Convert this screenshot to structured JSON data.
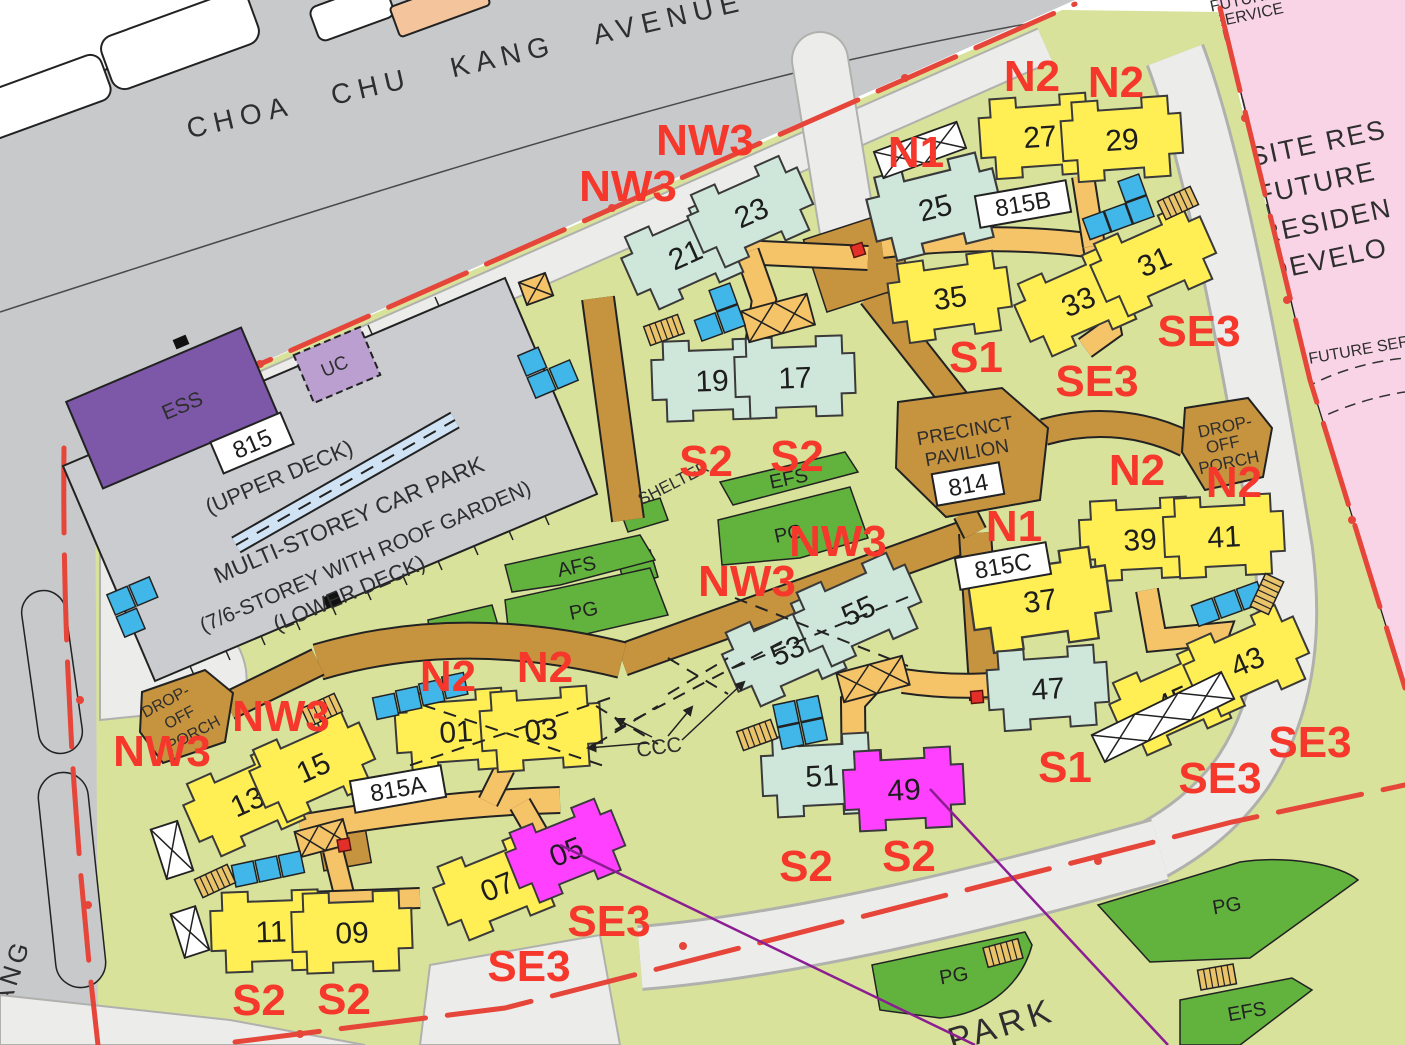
{
  "streets": {
    "avenue": "CHOA CHU KANG AVENUE",
    "side_road_fragment": "ANG",
    "park_fragment": "PARK"
  },
  "future": {
    "line1": "SITE RES",
    "line2": "FUTURE",
    "line3": "RESIDEN",
    "line4": "DEVELO",
    "svc_top1": "FUTURE",
    "svc_top2": "SERVICE",
    "svc_mid": "FUTURE SER"
  },
  "carpark": {
    "id": "815",
    "upper": "(UPPER DECK)",
    "name": "MULTI-STOREY CAR PARK",
    "storey": "(7/6-STOREY WITH ROOF GARDEN)",
    "lower": "(LOWER DECK)",
    "ess": "ESS",
    "uc": "UC"
  },
  "pavilion": {
    "l1": "PRECINCT",
    "l2": "PAVILION",
    "id": "814"
  },
  "precincts": {
    "a": "815A",
    "b": "815B",
    "c": "815C"
  },
  "dropoff": {
    "l1": "DROP-",
    "l2": "OFF",
    "l3": "PORCH"
  },
  "amenities": {
    "efs": "EFS",
    "pg": "PG",
    "afs": "AFS",
    "yd": "YD",
    "shelter": "SHELTER",
    "ccc": "CCC"
  },
  "blocks": [
    "21",
    "23",
    "19",
    "17",
    "25",
    "27",
    "29",
    "35",
    "33",
    "31",
    "39",
    "41",
    "37",
    "45",
    "43",
    "47",
    "53",
    "55",
    "51",
    "49",
    "01",
    "03",
    "13",
    "15",
    "11",
    "09",
    "07",
    "05"
  ],
  "annotations": [
    "NW3",
    "NW3",
    "N1",
    "N2",
    "N2",
    "SE3",
    "SE3",
    "S1",
    "S2",
    "S2",
    "NW3",
    "NW3",
    "N1",
    "N2",
    "N2",
    "NW3",
    "NW3",
    "N2",
    "N2",
    "S1",
    "SE3",
    "SE3",
    "S2",
    "S2",
    "SE3",
    "SE3",
    "S2",
    "S2"
  ],
  "colors": {
    "annotation_red": "#f5382b",
    "boundary_red": "#e6453a",
    "block_yellow": "#ffef55",
    "block_teal": "#cfe7da",
    "block_magenta": "#ff40ff",
    "amenity_green": "#62b33e",
    "site_green": "#d8e29a",
    "road_gray": "#c7c9cb",
    "path_gray": "#ecedea",
    "walkway_orange": "#f5c469",
    "walkway_tan": "#c6933f",
    "future_pink": "#f8d4e6",
    "ess_purple": "#7e58a8",
    "uc_purple": "#bb9fd0",
    "leader_purple": "#8c1d93"
  }
}
